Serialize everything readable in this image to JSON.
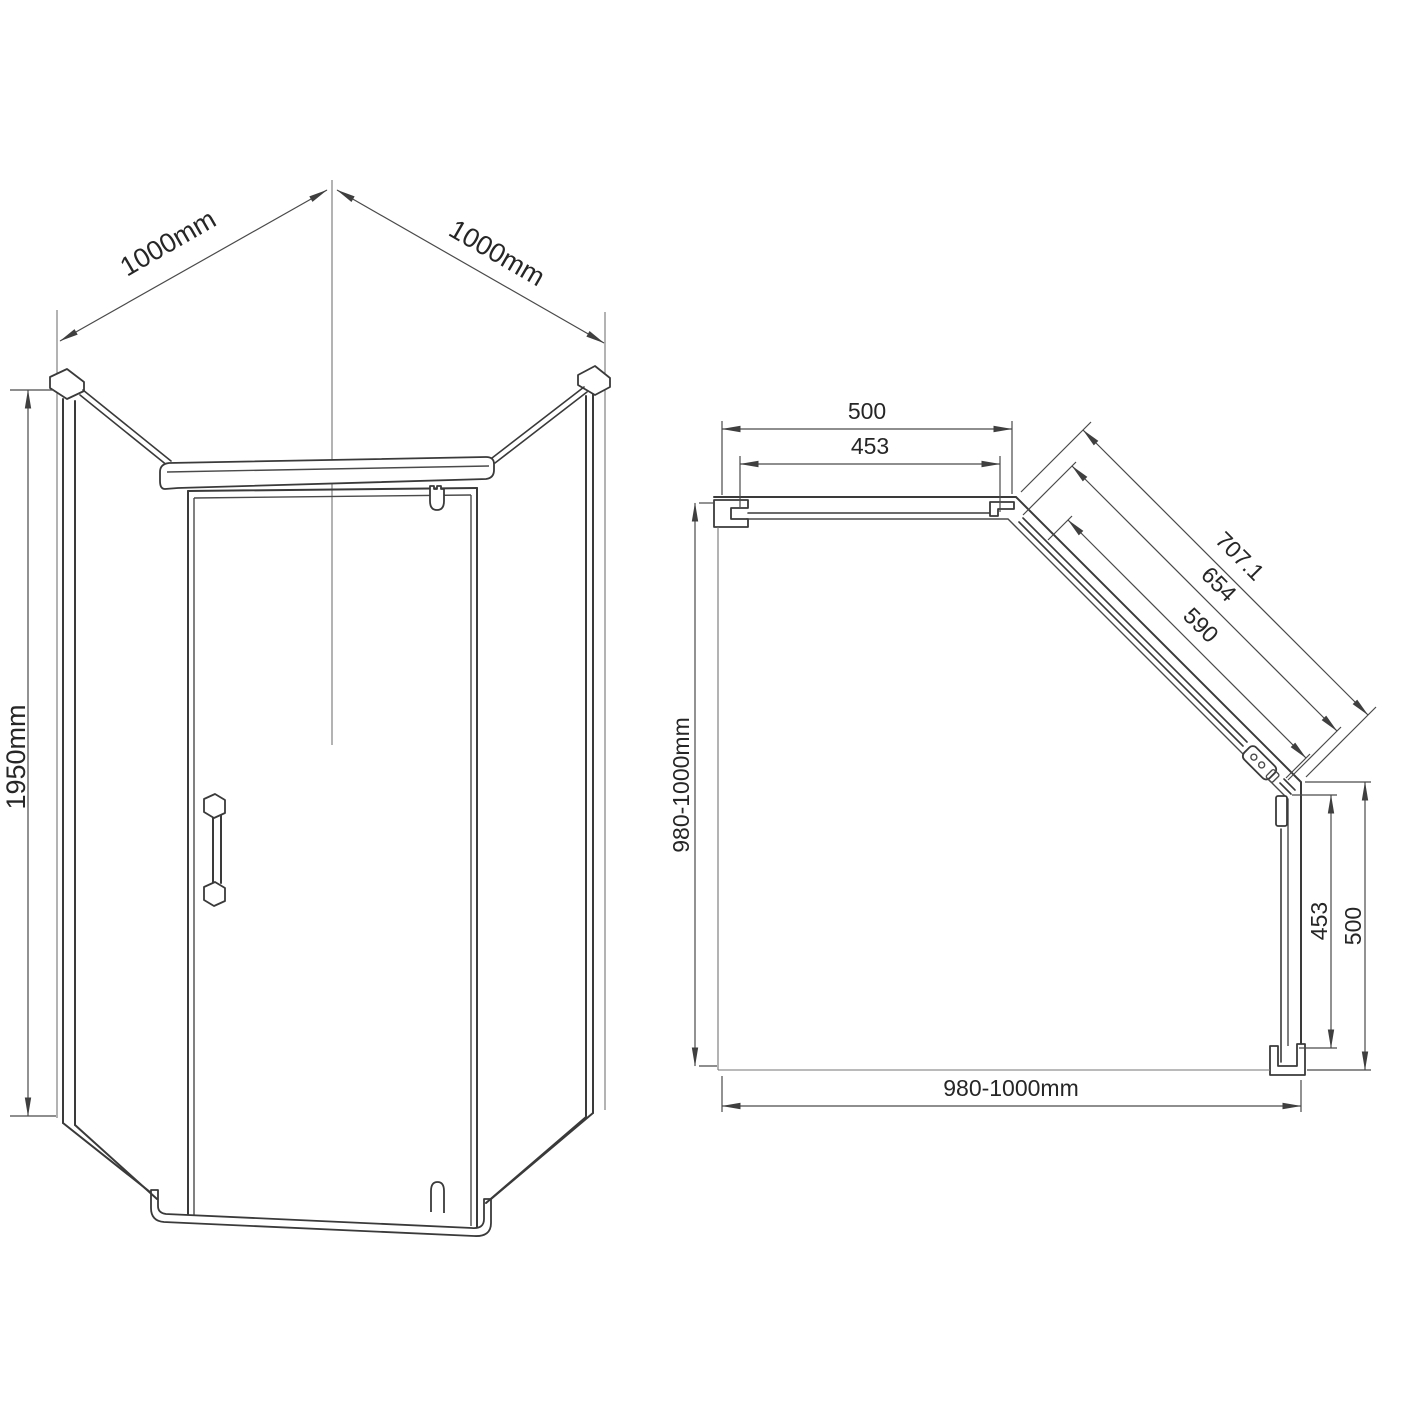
{
  "colors": {
    "background": "#ffffff",
    "drawing_line": "#3a3a3a",
    "dimension_line": "#4a4a4a",
    "text": "#262626"
  },
  "front_view": {
    "dim_width_left": "1000mm",
    "dim_width_right": "1000mm",
    "dim_height": "1950mm"
  },
  "plan_view": {
    "dim_top_outer": "500",
    "dim_top_inner": "453",
    "dim_diag_outer": "707.1",
    "dim_diag_mid": "654",
    "dim_diag_inner": "590",
    "dim_left": "980-1000mm",
    "dim_right_inner": "453",
    "dim_right_outer": "500",
    "dim_bottom": "980-1000mm"
  }
}
